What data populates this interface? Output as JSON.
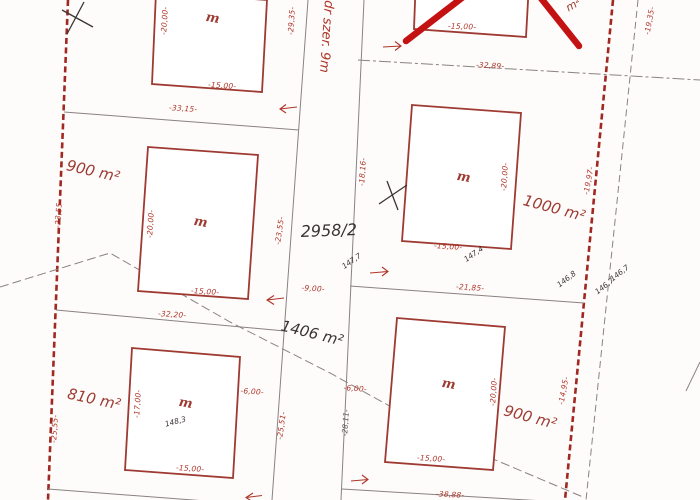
{
  "map": {
    "parcel_number": "2958/2",
    "road_label": "dr szer. 9m",
    "road_parcel_area": "1406 m²",
    "plot_areas": {
      "left_middle": "900 m²",
      "left_bottom": "810 m²",
      "right_middle": "1000 m²",
      "right_bottom": "900 m²",
      "top_right_cut": "m²"
    },
    "building_mark": "m",
    "dims": {
      "front_15": "-15,00-",
      "depth_20": "-20,00-",
      "depth_17": "-17,00-",
      "left_block_top": "-33,15-",
      "left_block_mid": "-32,20-",
      "right_block_top": "-32,89-",
      "right_block_mid": "-21,85-",
      "right_block_bottom": "-38,88-",
      "road_edge_top": "-29,35-",
      "road_edge_mid": "-18,16-",
      "road_edge_bottom": "-28,11-",
      "left_boundary_mid": "-23,55-",
      "left_boundary_bottom": "-25,55-",
      "plot810_side": "-25,51-",
      "right_boundary_top": "-19,35-",
      "right_boundary_mid": "-19,97-",
      "right_boundary_bottom": "-14,95-",
      "road_width": "-9,00-",
      "setback_6": "-6,00-"
    },
    "spot_heights": {
      "s147_7": "147,7",
      "s147_4": "147,4",
      "s148_3": "148,3",
      "s146_8": "146,8",
      "s146_7": "146,7"
    },
    "colors": {
      "map_red": "#9e3a31",
      "dim_red": "#b03428",
      "cross_red": "#c41111",
      "line_gray": "#8a8280",
      "ink_black": "#3a3432",
      "paper": "#fdfcfb"
    }
  }
}
